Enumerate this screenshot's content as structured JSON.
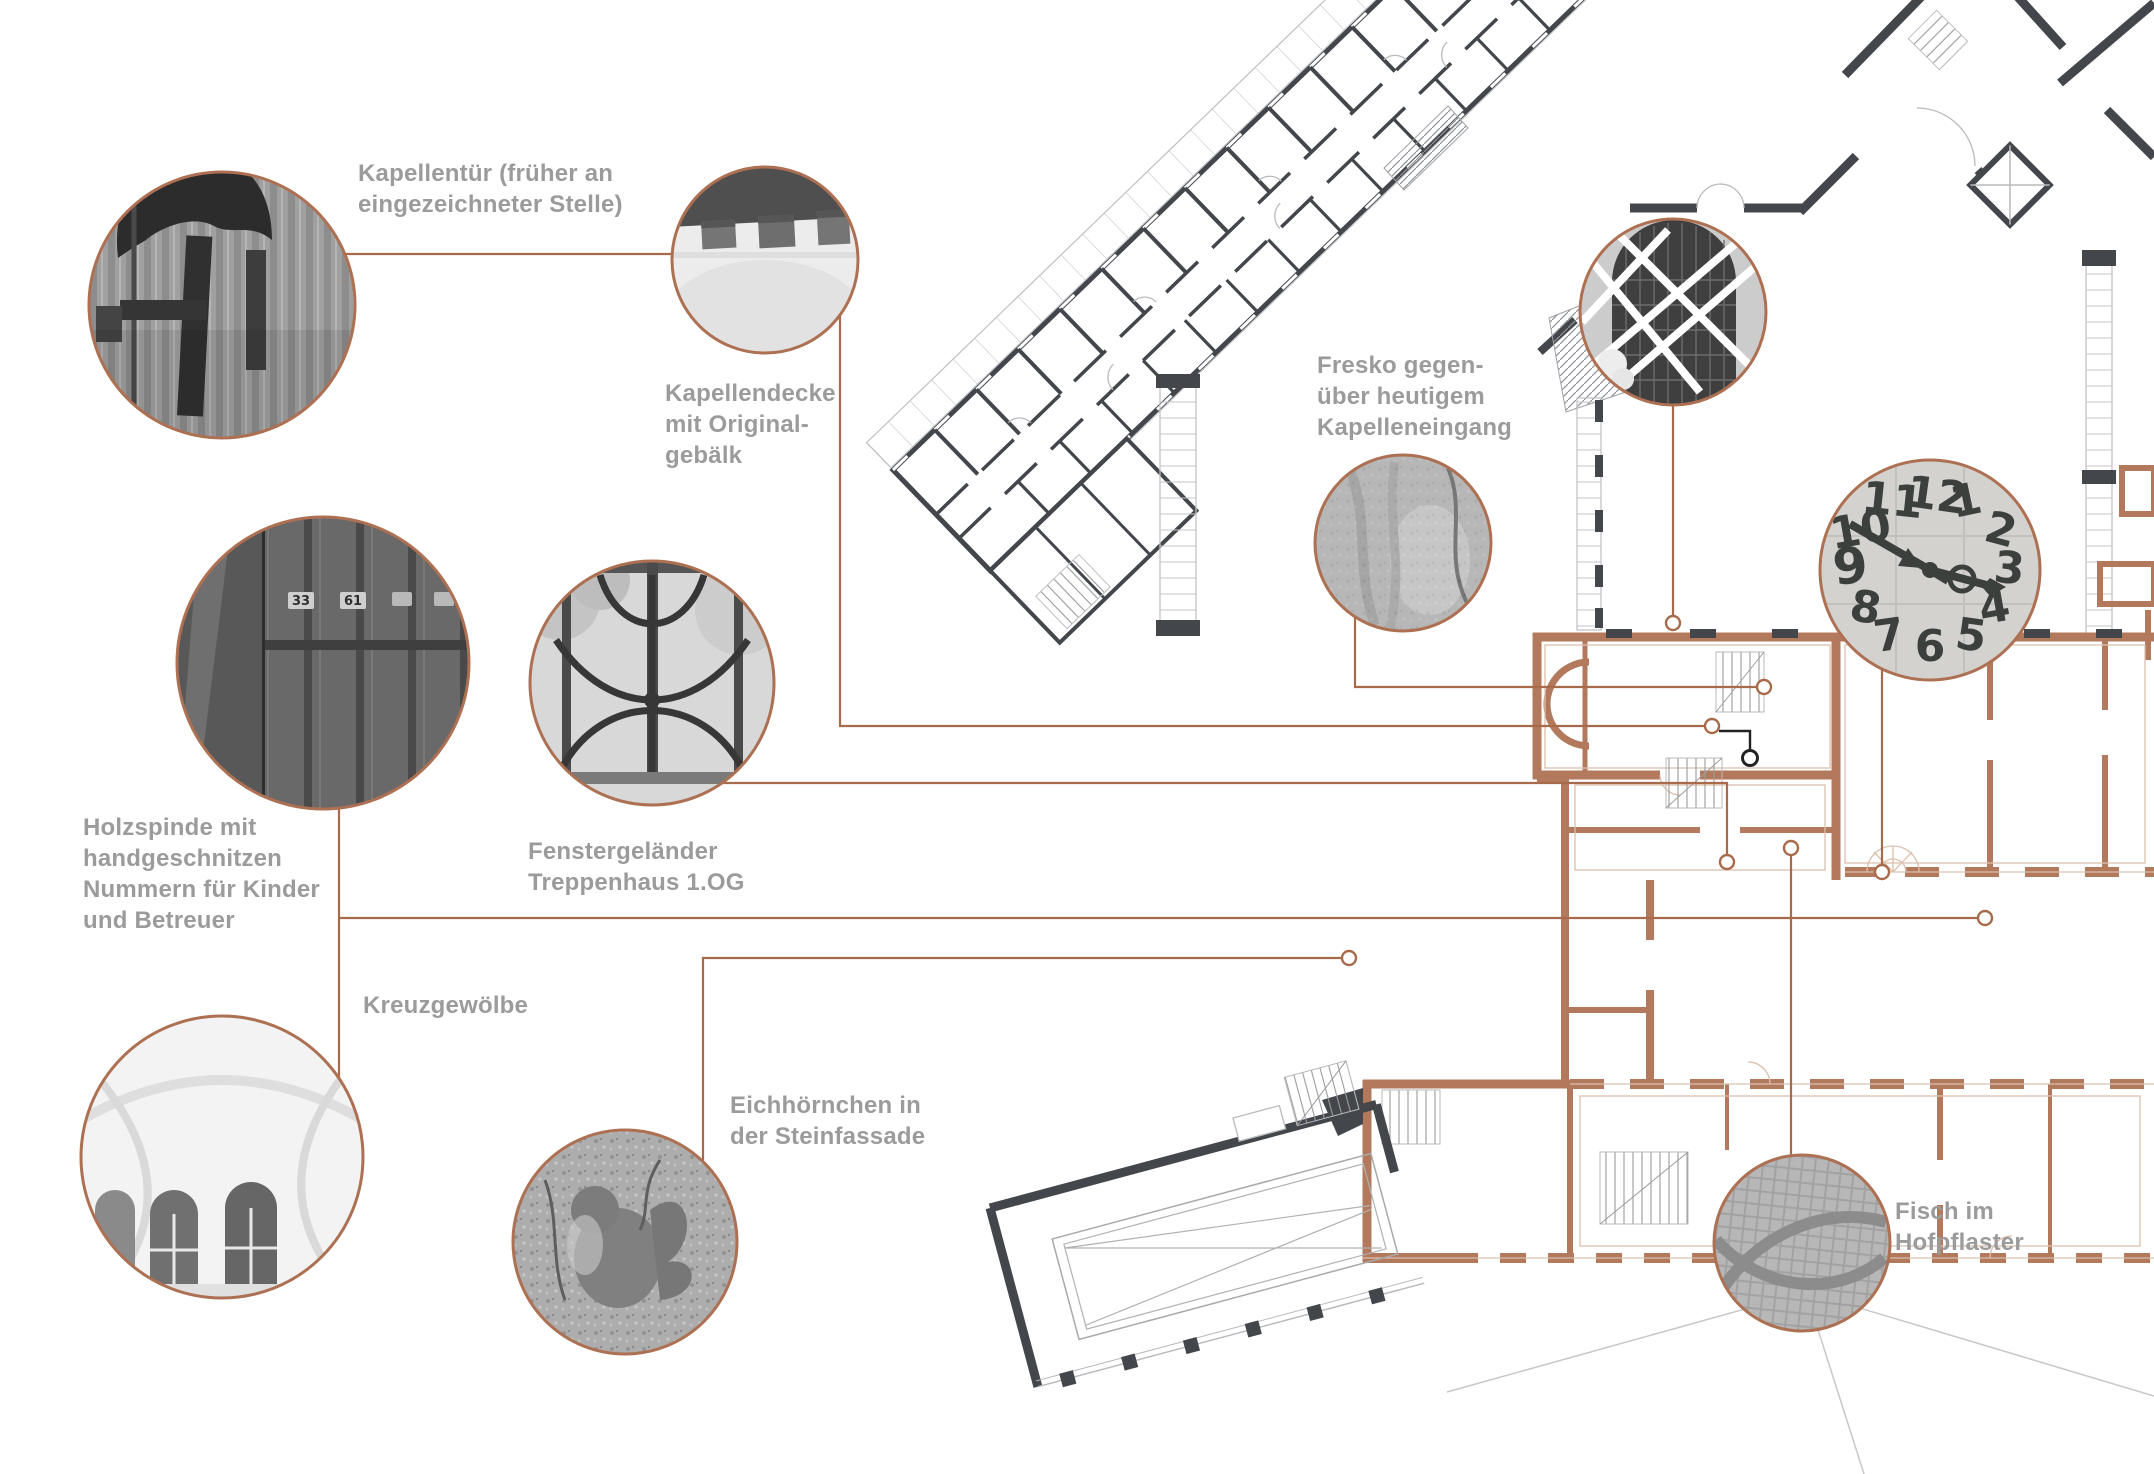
{
  "title": "Annotated historic building floor plan with photo call-outs",
  "colors": {
    "accent_copper_wall": "#b3795c",
    "copper_light_line": "#dcc0ae",
    "leader_line": "#a86a4b",
    "photo_ring": "#ad7053",
    "plan_dark_wall": "#43464b",
    "plan_light_line": "#c2c3c5",
    "label_text": "#9b9b9b",
    "background": "#ffffff"
  },
  "labels": {
    "kapellentuer": "Kapellentür (früher an\neingezeichneter Stelle)",
    "kapellendecke": "Kapellendecke\nmit Original-\ngebälk",
    "fresko": "Fresko gegen-\nüber heutigem\nKapelleneingang",
    "holzspinde": "Holzspinde mit\nhandgeschnitzen\nNummern für Kinder\nund Betreuer",
    "fenstergelaender": "Fenstergeländer\nTreppenhaus 1.OG",
    "kreuzgewoelbe": "Kreuzgewölbe",
    "eichhoernchen": "Eichhörnchen in\nder Steinfassade",
    "fisch": "Fisch im\nHofpflaster"
  },
  "photos": [
    {
      "name": "chapel-door-photo"
    },
    {
      "name": "chapel-ceiling-photo"
    },
    {
      "name": "wooden-lockers-photo"
    },
    {
      "name": "window-railing-photo"
    },
    {
      "name": "cross-vault-photo"
    },
    {
      "name": "squirrel-stone-photo"
    },
    {
      "name": "fresco-photo"
    },
    {
      "name": "chapel-entrance-photo"
    },
    {
      "name": "stone-clock-photo"
    },
    {
      "name": "fish-mosaic-photo"
    }
  ],
  "clock": {
    "numerals": [
      "1",
      "2",
      "3",
      "4",
      "5",
      "6",
      "7",
      "8",
      "9",
      "10",
      "11",
      "12"
    ]
  },
  "lockers": {
    "plaques": [
      "33",
      "61"
    ]
  }
}
